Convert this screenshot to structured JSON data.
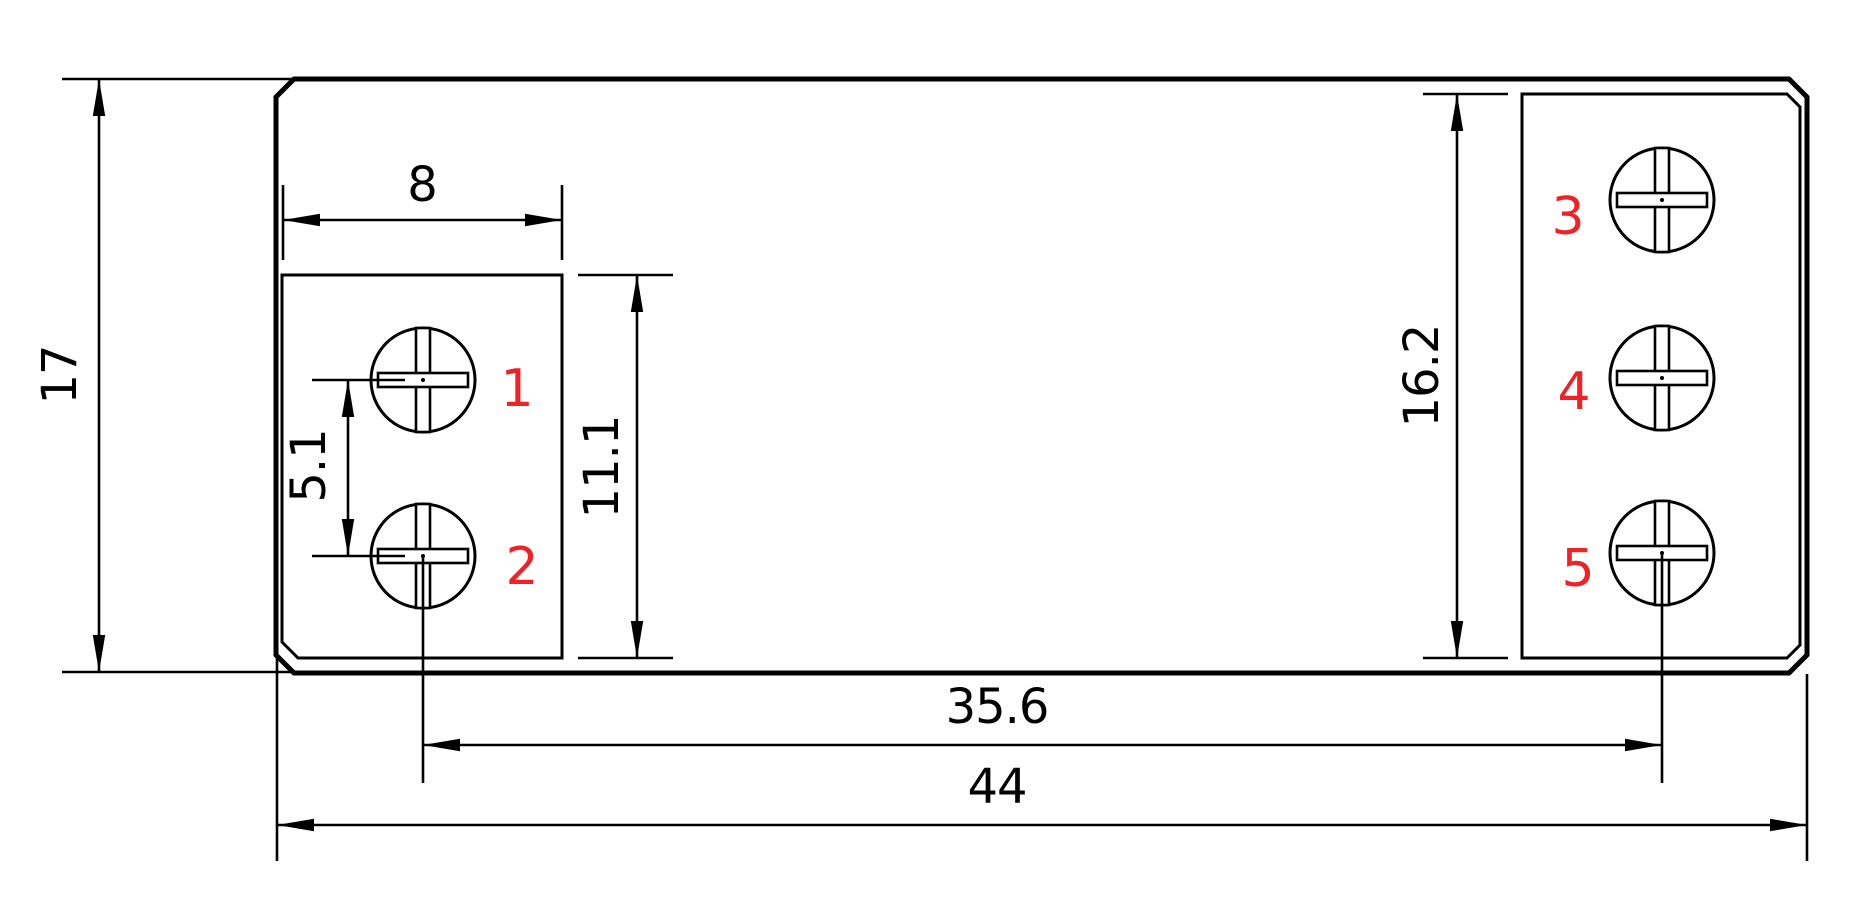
{
  "drawing": {
    "kind": "technical-dimension-drawing",
    "colors": {
      "line": "#000000",
      "background": "#ffffff",
      "screw_label": "#ee2328"
    },
    "dimensions": {
      "overall_height": "17",
      "overall_width": "44",
      "screw_span": "35.6",
      "left_block_width": "8",
      "left_block_height": "11.1",
      "left_screw_pitch": "5.1",
      "right_block_height": "16.2"
    },
    "screw_labels": [
      "1",
      "2",
      "3",
      "4",
      "5"
    ]
  }
}
